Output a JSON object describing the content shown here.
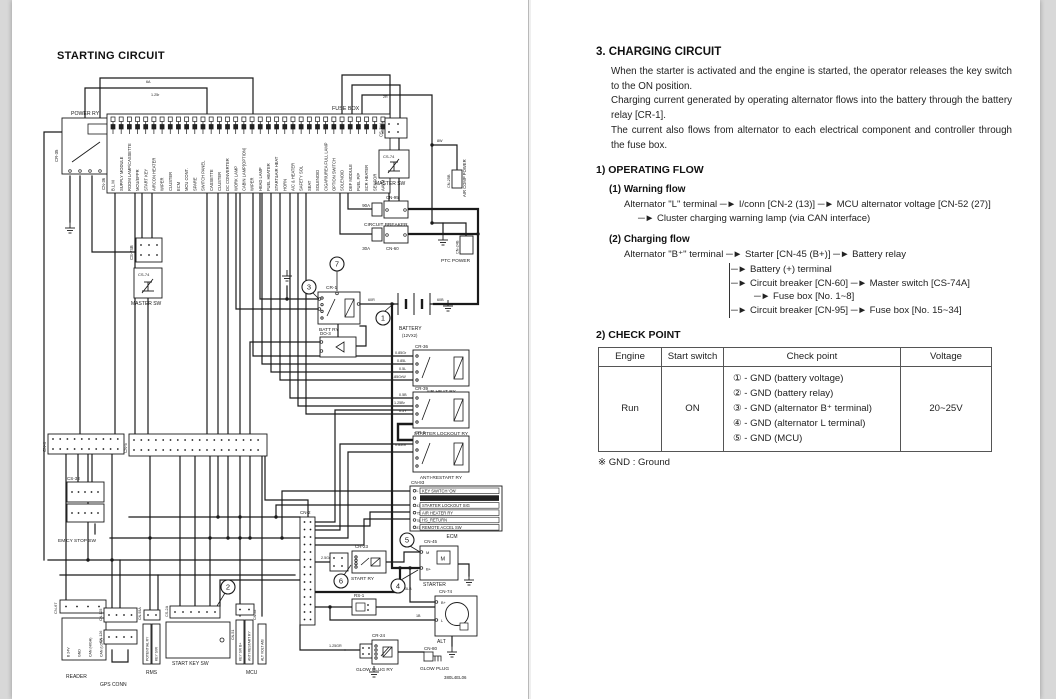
{
  "left_page": {
    "title": "STARTING CIRCUIT",
    "doc_number": "380L4EL06",
    "fusebox": {
      "label": "FUSE BOX",
      "connector": "CN-36",
      "fuses": [
        "B.L.M",
        "SUPPLY MODULE",
        "ROOM LAMP/CASSETTE",
        "MCU/EPPR",
        "START KEY",
        "AIRCON HEATER",
        "WIPER",
        "CLUSTER",
        "ECM",
        "MCU CONT.",
        "SPARE",
        "SWITCH PANEL",
        "CASSETTE",
        "CLUSTER",
        "DC CONVERTER",
        "WORK LAMP",
        "CABIN LAMP(OPTION)",
        "WIPER",
        "HEAD LAMP",
        "FUEL HEATER",
        "START&AIR HEAT",
        "HORN",
        "A/C & HEATER",
        "SAFETY SOL",
        "SEAT",
        "SOLENOID",
        "CIGAR/UREA FULL LAMP",
        "OPTION SWITCH",
        "SOLENOID",
        "DEF MODULE",
        "FUEL P/P",
        "SCR HEATER",
        "SENSOR",
        "AAVM"
      ]
    },
    "components": {
      "power_ry": {
        "label": "POWER RY",
        "ref": "CR-35"
      },
      "cs74a": {
        "ref": "CS-74A"
      },
      "master_top": {
        "label": "MASTER SW",
        "ref": "CS-74"
      },
      "cb95": {
        "label": "CIRCUIT BREAKER",
        "ref": "CN-95",
        "amp": "90A"
      },
      "cb60": {
        "ref": "CN-60",
        "amp": "30A"
      },
      "air_comp": {
        "label": "AIR COMP POWER",
        "ref": "CN-25B"
      },
      "ptc": {
        "label": "PTC POWER",
        "ref": "CN-24B"
      },
      "cs74b": {
        "ref": "CS-74B"
      },
      "master_mid": {
        "label": "MASTER SW",
        "ref": "CS-74"
      },
      "cr1": {
        "label": "BATT RY",
        "ref": "CR-1"
      },
      "do3": {
        "ref": "DO-3"
      },
      "battery": {
        "label": "BATTERY",
        "sub": "(12VX2)"
      },
      "cr36": {
        "label": "AIR HEAT RY",
        "ref": "CR-36"
      },
      "cr39": {
        "label": "STARTER LOCKOUT RY",
        "ref": "CR-39"
      },
      "cr5": {
        "label": "ANTI-RESTART RY",
        "ref": "CR-5"
      },
      "ecm": {
        "label": "ECM",
        "ref": "CN-93",
        "pins": [
          "L",
          "43",
          "75",
          "78",
          "87"
        ],
        "rows": [
          "KEY SWITCH 'ON'",
          "",
          "STARTER LOCKOUT SIG",
          "AIR HEATER RY",
          "HS_RETURN",
          "REMOTE ACCEL SW"
        ]
      },
      "cn2": {
        "ref": "CN-2"
      },
      "cr23": {
        "label": "START RY",
        "ref": "CR-23"
      },
      "starter": {
        "label": "STARTER",
        "ref": "CN-45",
        "pins": [
          "M",
          "B+"
        ]
      },
      "rs1": {
        "ref": "RS-1"
      },
      "alt": {
        "label": "ALT",
        "ref": "CN-74",
        "pins": [
          "B+",
          "L"
        ]
      },
      "cr24": {
        "label": "GLOW PLUG RY",
        "ref": "CR-24"
      },
      "glow": {
        "label": "GLOW PLUG",
        "ref": "CN-80"
      },
      "cn4": {
        "ref": "CN-4"
      },
      "cn5": {
        "ref": "CN-5"
      },
      "cs33": {
        "label": "EM'CY STOP SW",
        "ref": "CS-33"
      },
      "reader": {
        "label": "READER",
        "ref": "CN-67",
        "pins": [
          "B 24V",
          "GND",
          "CAN (HIGH)",
          "CAN (LOW)"
        ]
      },
      "gps": {
        "label": "GPS CONN",
        "refs": [
          "CN-125",
          "CN-126"
        ]
      },
      "rms": {
        "label": "RMS",
        "ref": "CN-93A",
        "pins": [
          "POTENTIAL RY",
          "KEY S/W"
        ]
      },
      "start_key": {
        "label": "START KEY SW",
        "ref": "CS-2A"
      },
      "mcu": {
        "label": "MCU",
        "refs": [
          "CN-51",
          "CN-52"
        ],
        "pins": [
          "KEY SW B+",
          "ANTI RESTART RY",
          "ALT VOLT A/B"
        ]
      }
    },
    "callouts": [
      "1",
      "2",
      "3",
      "4",
      "5",
      "6",
      "7"
    ],
    "wire_labels": [
      {
        "t": "6A",
        "x": 146,
        "y": 83
      },
      {
        "t": "1.25r",
        "x": 151,
        "y": 96
      },
      {
        "t": "2R",
        "x": 383,
        "y": 98
      },
      {
        "t": "8W",
        "x": 437,
        "y": 142
      },
      {
        "t": "60R",
        "x": 368,
        "y": 301
      },
      {
        "t": "60B",
        "x": 437,
        "y": 301
      },
      {
        "t": "0.85Gr",
        "x": 395,
        "y": 354
      },
      {
        "t": "0.85L",
        "x": 397,
        "y": 362
      },
      {
        "t": "0.5L",
        "x": 399,
        "y": 370
      },
      {
        "t": "0.85GrW",
        "x": 391,
        "y": 378
      },
      {
        "t": "0.5B",
        "x": 399,
        "y": 396
      },
      {
        "t": "1.25Br",
        "x": 394,
        "y": 404
      },
      {
        "t": "0.5Y",
        "x": 399,
        "y": 412
      },
      {
        "t": "0.85Gr",
        "x": 395,
        "y": 446
      },
      {
        "t": "2.5Gr",
        "x": 321,
        "y": 559
      },
      {
        "t": "5LB",
        "x": 405,
        "y": 590
      },
      {
        "t": "1B",
        "x": 416,
        "y": 617
      },
      {
        "t": "1.25GR",
        "x": 329,
        "y": 647
      }
    ]
  },
  "right_page": {
    "heading": "3. CHARGING CIRCUIT",
    "paragraphs": [
      "When the starter is activated and the engine is started, the operator releases the key switch to the ON position.",
      "Charging current generated by operating alternator flows into the battery through the battery relay [CR-1].",
      "The current also flows from alternator to each electrical component and controller through the fuse box."
    ],
    "operating_flow": {
      "heading": "1) OPERATING FLOW",
      "arrow": "─►",
      "warning": {
        "heading": "(1) Warning flow",
        "line1": "Alternator \"L\" terminal  ─►  I/conn [CN-2 (13)]  ─►  MCU alternator voltage [CN-52 (27)]",
        "line2": "─►  Cluster charging warning lamp (via CAN interface)"
      },
      "charging": {
        "heading": "(2) Charging flow",
        "line1": "Alternator \"B⁺\" terminal  ─►  Starter [CN-45 (B+)]  ─►  Battery relay",
        "branches": [
          "Battery (+) terminal",
          "Circuit breaker [CN-60]  ─►  Master switch [CS-74A]",
          "Fuse box [No. 1~8]",
          "Circuit breaker [CN-95]  ─►  Fuse box [No. 15~34]"
        ]
      }
    },
    "check_point": {
      "heading": "2) CHECK POINT",
      "headers": [
        "Engine",
        "Start switch",
        "Check point",
        "Voltage"
      ],
      "engine": "Run",
      "start_switch": "ON",
      "checks": [
        "① - GND (battery voltage)",
        "② - GND (battery relay)",
        "③ - GND (alternator B⁺ terminal)",
        "④ - GND (alternator L terminal)",
        "⑤ - GND (MCU)"
      ],
      "voltage": "20~25V"
    },
    "footnote": "※ GND : Ground"
  }
}
